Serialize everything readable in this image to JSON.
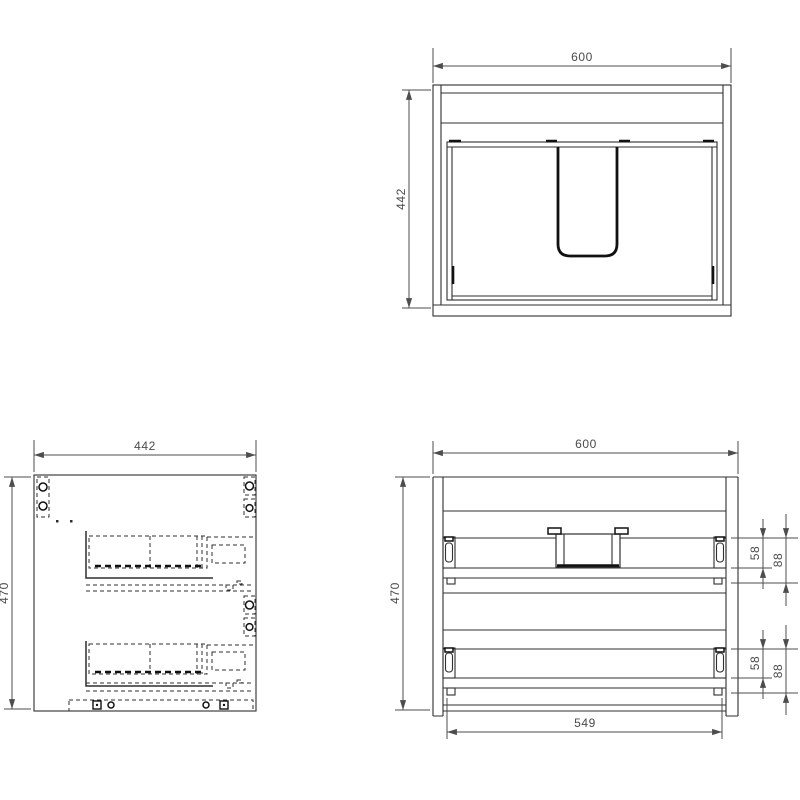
{
  "drawing": {
    "type": "cabinet-technical-drawing",
    "background_color": "#ffffff",
    "line_color": "#2f2f2f",
    "dimension_color": "#4a4a4a",
    "views": {
      "top": {
        "label": "top-view",
        "width_mm": "600",
        "depth_mm": "442"
      },
      "side": {
        "label": "side-view",
        "width_mm": "442",
        "height_mm": "470"
      },
      "front": {
        "label": "front-view",
        "width_mm": "600",
        "height_mm": "470",
        "bottom_rail_width_mm": "549",
        "top_drawer": {
          "slide_height_mm": "58",
          "overall_height_mm": "88"
        },
        "bottom_drawer": {
          "slide_height_mm": "58",
          "overall_height_mm": "88"
        }
      }
    }
  }
}
